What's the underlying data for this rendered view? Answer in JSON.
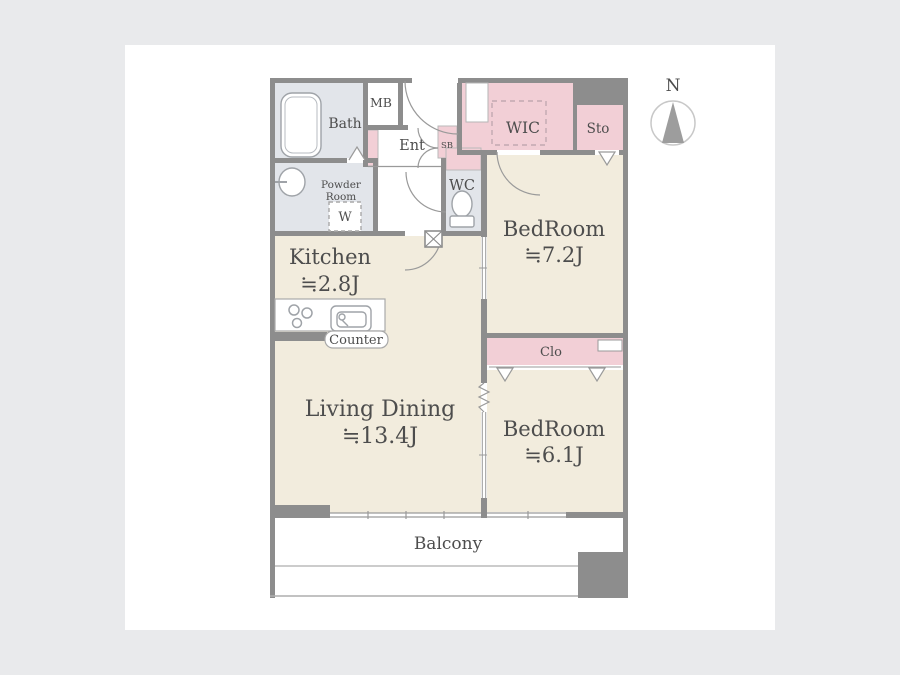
{
  "plan": {
    "bath": "Bath",
    "powder_room_line1": "Powder",
    "powder_room_line2": "Room",
    "washer": "W",
    "meter_box": "MB",
    "entrance": "Ent",
    "shoe_box": "SB",
    "toilet_room": "WC",
    "walk_in_closet": "WIC",
    "storage": "Sto",
    "kitchen_name": "Kitchen",
    "kitchen_size": "≒2.8J",
    "counter": "Counter",
    "living_name": "Living Dining",
    "living_size": "≒13.4J",
    "bedroom_a_name": "BedRoom",
    "bedroom_a_size": "≒7.2J",
    "closet": "Clo",
    "bedroom_b_name": "BedRoom",
    "bedroom_b_size": "≒6.1J",
    "balcony": "Balcony",
    "compass_north": "N"
  },
  "colors": {
    "background": "#e9eaec",
    "canvas": "#ffffff",
    "wall": "#8d8d8d",
    "room_floor_beige": "#f2ecdd",
    "closet_pink": "#f2cfd6",
    "wet_area_gray": "#e2e5ea",
    "text": "#4d4d4d"
  }
}
